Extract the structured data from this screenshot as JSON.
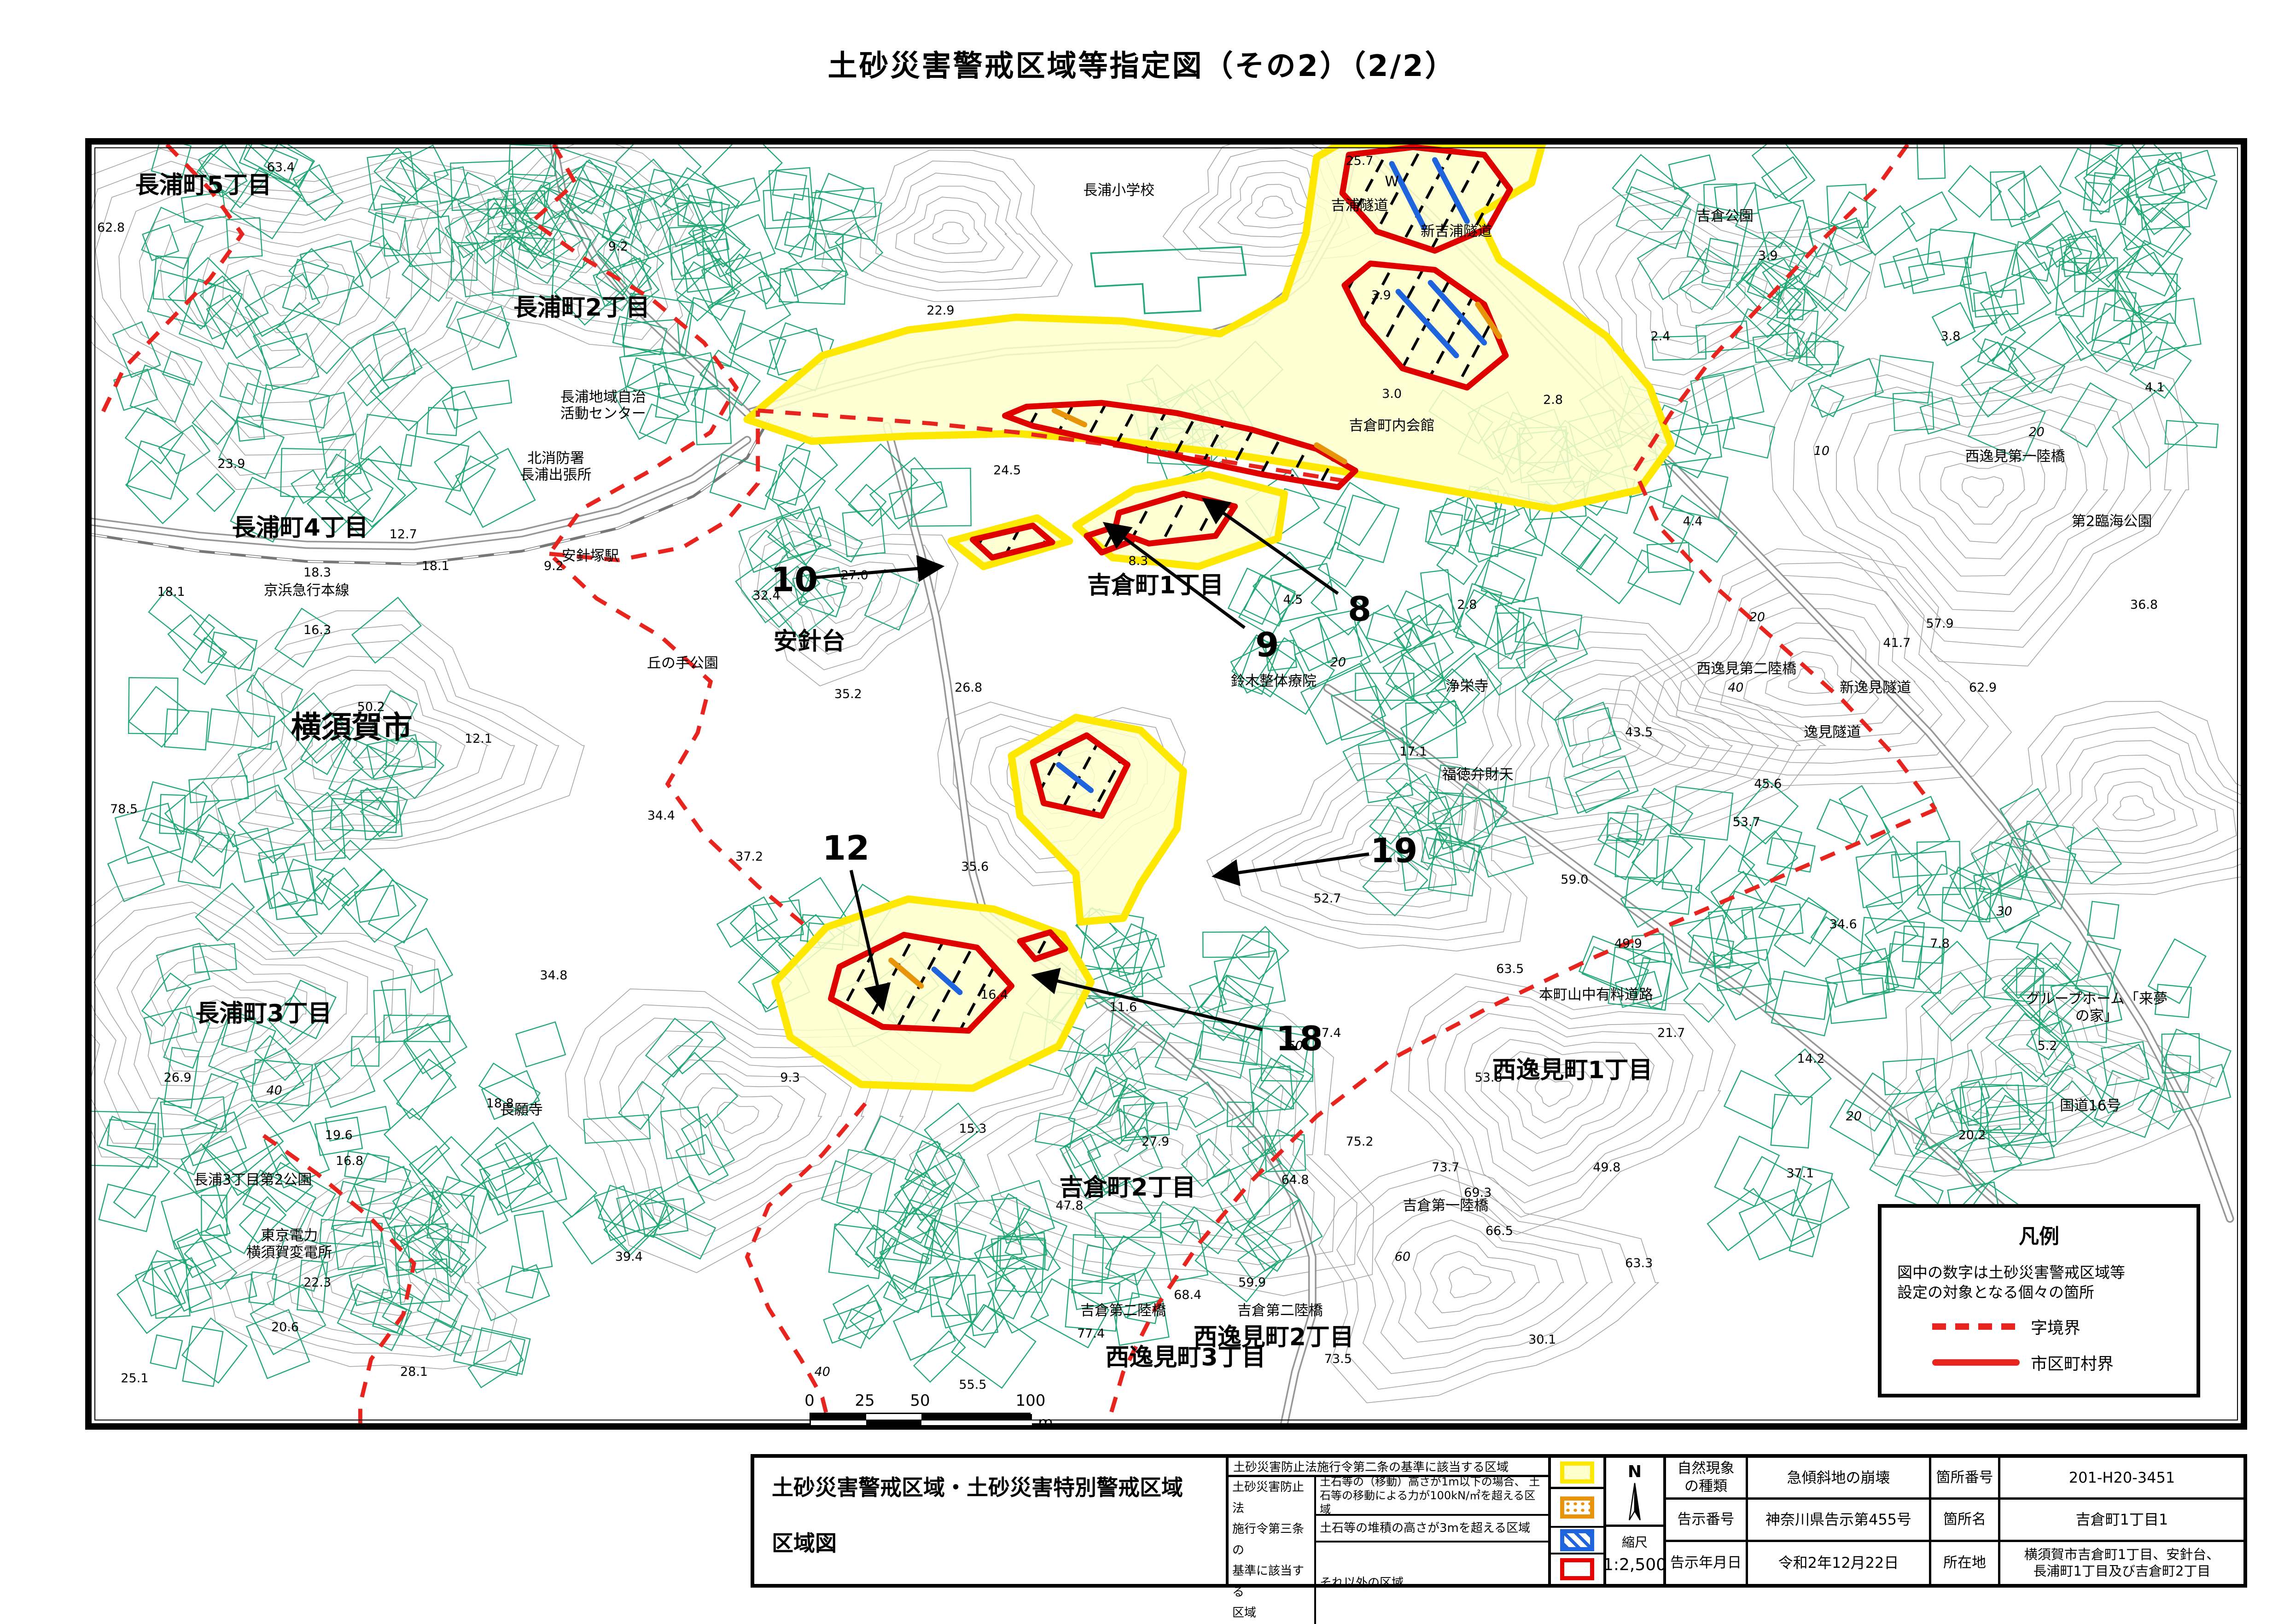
{
  "page": {
    "title": "土砂災害警戒区域等指定図（その2）（2/2）"
  },
  "scalebar": {
    "ticks": [
      "0",
      "25",
      "50",
      "100"
    ],
    "unit": "m"
  },
  "legend_box": {
    "title": "凡例",
    "note": "図中の数字は土砂災害警戒区域等\n設定の対象となる個々の箇所",
    "items": [
      {
        "style": "dashed",
        "label": "字境界"
      },
      {
        "style": "solid",
        "label": "市区町村界"
      }
    ]
  },
  "footer": {
    "doc_title_line1": "土砂災害警戒区域・土砂災害特別警戒区域",
    "doc_title_line2": "区域図",
    "legend": {
      "row1": "土砂災害防止法施行令第二条の基準に該当する区域",
      "group_label": "土砂災害防止法\n施行令第三条の\n基準に該当する\n区域",
      "row2": "土石等の（移動）高さが1m以下の場合、\n土石等の移動による力が100kN/㎡を超える区域",
      "row3": "土石等の堆積の高さが3mを超える区域",
      "row4": "それ以外の区域"
    },
    "north_label": "N",
    "scale_label": "縮尺",
    "scale_value": "1:2,500",
    "info": {
      "phenomenon_label": "自然現象\nの種類",
      "phenomenon": "急傾斜地の崩壊",
      "site_no_label": "箇所番号",
      "site_no": "201-H20-3451",
      "notice_no_label": "告示番号",
      "notice_no": "神奈川県告示第455号",
      "site_name_label": "箇所名",
      "site_name": "吉倉町1丁目1",
      "notice_date_label": "告示年月日",
      "notice_date": "令和2年12月22日",
      "location_label": "所在地",
      "location": "横須賀市吉倉町1丁目、安針台、\n長浦町1丁目及び吉倉町2丁目"
    }
  },
  "map": {
    "colors": {
      "hazard_yellow_fill": "#FFFFCC",
      "hazard_yellow_border": "#FFE800",
      "special_red": "#DF0000",
      "debris_orange": "#E8940A",
      "deposit_blue": "#1E64DC",
      "boundary_red": "#E8241F",
      "contour_gray": "#A3A3A3",
      "building_green": "#21A876",
      "road_gray": "#8C8C8C"
    },
    "pointers": [
      {
        "n": "8",
        "x": 59.0,
        "y": 36.3,
        "tx": 51.8,
        "ty": 27.8
      },
      {
        "n": "9",
        "x": 54.7,
        "y": 39.1,
        "tx": 47.2,
        "ty": 29.7
      },
      {
        "n": "10",
        "x": 32.7,
        "y": 34.0,
        "tx": 39.5,
        "ty": 33.0
      },
      {
        "n": "12",
        "x": 35.1,
        "y": 55.0,
        "tx": 36.8,
        "ty": 67.5
      },
      {
        "n": "18",
        "x": 56.2,
        "y": 69.9,
        "tx": 43.9,
        "ty": 65.0
      },
      {
        "n": "19",
        "x": 60.6,
        "y": 55.2,
        "tx": 52.3,
        "ty": 57.2
      }
    ],
    "labels": [
      {
        "t": "長浦町5丁目",
        "x": 5.2,
        "y": 3.2,
        "c": "lg"
      },
      {
        "t": "長浦町2丁目",
        "x": 22.8,
        "y": 12.8,
        "c": "lg"
      },
      {
        "t": "長浦町4丁目",
        "x": 9.7,
        "y": 30.0,
        "c": "lg"
      },
      {
        "t": "長浦町3丁目",
        "x": 8.0,
        "y": 68.0,
        "c": "lg"
      },
      {
        "t": "横須賀市",
        "x": 12.1,
        "y": 45.6,
        "c": "xl"
      },
      {
        "t": "安針台",
        "x": 33.4,
        "y": 38.9,
        "c": "lg"
      },
      {
        "t": "吉倉町1丁目",
        "x": 49.5,
        "y": 34.5,
        "c": "lg"
      },
      {
        "t": "吉倉町2丁目",
        "x": 48.2,
        "y": 81.6,
        "c": "lg"
      },
      {
        "t": "西逸見町1丁目",
        "x": 68.9,
        "y": 72.4,
        "c": "lg"
      },
      {
        "t": "西逸見町2丁目",
        "x": 55.0,
        "y": 93.3,
        "c": "lg"
      },
      {
        "t": "西逸見町3丁目",
        "x": 50.9,
        "y": 94.9,
        "c": "lg"
      },
      {
        "t": "長浦小学校",
        "x": 47.8,
        "y": 3.6,
        "c": "sm"
      },
      {
        "t": "W",
        "x": 60.5,
        "y": 2.9,
        "c": "sm"
      },
      {
        "t": "吉浦隧道",
        "x": 59.0,
        "y": 4.8,
        "c": "sm"
      },
      {
        "t": "新吉浦隧道",
        "x": 63.5,
        "y": 6.8,
        "c": "sm"
      },
      {
        "t": "吉倉町内会館",
        "x": 60.5,
        "y": 22.0,
        "c": "sm"
      },
      {
        "t": "吉倉公園",
        "x": 76.0,
        "y": 5.6,
        "c": "sm"
      },
      {
        "t": "西逸見第一陸橋",
        "x": 89.5,
        "y": 24.4,
        "c": "sm"
      },
      {
        "t": "第2臨海公園",
        "x": 94.0,
        "y": 29.5,
        "c": "sm"
      },
      {
        "t": "長浦地域自治\n活動センター",
        "x": 23.8,
        "y": 20.4,
        "c": "sm"
      },
      {
        "t": "北消防署\n長浦出張所",
        "x": 21.6,
        "y": 25.2,
        "c": "sm"
      },
      {
        "t": "安針塚駅",
        "x": 23.2,
        "y": 32.2,
        "c": "sm"
      },
      {
        "t": "丘の手公園",
        "x": 27.5,
        "y": 40.6,
        "c": "sm"
      },
      {
        "t": "京浜急行本線",
        "x": 10.0,
        "y": 34.9,
        "c": "sm"
      },
      {
        "t": "鈴木整体療院",
        "x": 55.0,
        "y": 42.0,
        "c": "sm"
      },
      {
        "t": "浄栄寺",
        "x": 64.0,
        "y": 42.4,
        "c": "sm"
      },
      {
        "t": "西逸見第二陸橋",
        "x": 77.0,
        "y": 41.0,
        "c": "sm"
      },
      {
        "t": "新逸見隧道",
        "x": 83.0,
        "y": 42.5,
        "c": "sm"
      },
      {
        "t": "逸見隧道",
        "x": 81.0,
        "y": 46.0,
        "c": "sm"
      },
      {
        "t": "福徳弁財天",
        "x": 64.5,
        "y": 49.3,
        "c": "sm"
      },
      {
        "t": "長願寺",
        "x": 20.0,
        "y": 75.5,
        "c": "sm"
      },
      {
        "t": "長浦3丁目第2公園",
        "x": 7.5,
        "y": 81.0,
        "c": "sm"
      },
      {
        "t": "東京電力\n横須賀変電所",
        "x": 9.2,
        "y": 86.0,
        "c": "sm"
      },
      {
        "t": "本町山中有料道路",
        "x": 70.0,
        "y": 66.5,
        "c": "sm"
      },
      {
        "t": "グループホーム「来夢の家」",
        "x": 93.3,
        "y": 67.5,
        "c": "sm"
      },
      {
        "t": "国道16号",
        "x": 93.0,
        "y": 75.2,
        "c": "sm"
      },
      {
        "t": "吉倉第一陸橋",
        "x": 63.0,
        "y": 83.0,
        "c": "sm"
      },
      {
        "t": "吉倉第二陸橋",
        "x": 48.0,
        "y": 91.2,
        "c": "sm"
      },
      {
        "t": "吉倉第二陸橋",
        "x": 55.3,
        "y": 91.2,
        "c": "sm"
      },
      {
        "t": "63.4",
        "x": 8.8,
        "y": 1.8,
        "c": "el"
      },
      {
        "t": "62.8",
        "x": 0.9,
        "y": 6.5,
        "c": "el"
      },
      {
        "t": "9.2",
        "x": 24.5,
        "y": 8.0,
        "c": "el"
      },
      {
        "t": "23.9",
        "x": 6.5,
        "y": 25.0,
        "c": "el"
      },
      {
        "t": "12.7",
        "x": 14.5,
        "y": 30.5,
        "c": "el"
      },
      {
        "t": "16.3",
        "x": 10.5,
        "y": 38.0,
        "c": "el"
      },
      {
        "t": "9.2",
        "x": 21.5,
        "y": 33.0,
        "c": "el"
      },
      {
        "t": "22.9",
        "x": 39.5,
        "y": 13.0,
        "c": "el"
      },
      {
        "t": "25.7",
        "x": 59.0,
        "y": 1.3,
        "c": "el"
      },
      {
        "t": "24.5",
        "x": 42.6,
        "y": 25.5,
        "c": "el"
      },
      {
        "t": "27.0",
        "x": 35.5,
        "y": 33.7,
        "c": "el"
      },
      {
        "t": "32.4",
        "x": 31.4,
        "y": 35.3,
        "c": "el"
      },
      {
        "t": "35.2",
        "x": 35.2,
        "y": 43.0,
        "c": "el"
      },
      {
        "t": "34.4",
        "x": 26.5,
        "y": 52.5,
        "c": "el"
      },
      {
        "t": "37.2",
        "x": 30.6,
        "y": 55.7,
        "c": "el"
      },
      {
        "t": "12.1",
        "x": 18.0,
        "y": 46.5,
        "c": "el"
      },
      {
        "t": "18.1",
        "x": 3.7,
        "y": 35.0,
        "c": "el"
      },
      {
        "t": "18.3",
        "x": 10.5,
        "y": 33.5,
        "c": "el"
      },
      {
        "t": "18.1",
        "x": 16.0,
        "y": 33.0,
        "c": "el"
      },
      {
        "t": "50.2",
        "x": 13.0,
        "y": 44.0,
        "c": "el"
      },
      {
        "t": "78.5",
        "x": 1.5,
        "y": 52.0,
        "c": "el"
      },
      {
        "t": "26.9",
        "x": 4.0,
        "y": 73.0,
        "c": "el"
      },
      {
        "t": "19.6",
        "x": 11.5,
        "y": 77.5,
        "c": "el"
      },
      {
        "t": "18.8",
        "x": 19.0,
        "y": 75.0,
        "c": "el"
      },
      {
        "t": "34.8",
        "x": 21.5,
        "y": 65.0,
        "c": "el"
      },
      {
        "t": "22.3",
        "x": 10.5,
        "y": 89.0,
        "c": "el"
      },
      {
        "t": "39.4",
        "x": 25.0,
        "y": 87.0,
        "c": "el"
      },
      {
        "t": "28.1",
        "x": 15.0,
        "y": 96.0,
        "c": "el"
      },
      {
        "t": "25.1",
        "x": 2.0,
        "y": 96.5,
        "c": "el"
      },
      {
        "t": "20.6",
        "x": 9.0,
        "y": 92.5,
        "c": "el"
      },
      {
        "t": "16.8",
        "x": 12.0,
        "y": 79.5,
        "c": "el"
      },
      {
        "t": "8.3",
        "x": 48.7,
        "y": 32.6,
        "c": "el"
      },
      {
        "t": "4.5",
        "x": 55.9,
        "y": 35.6,
        "c": "el"
      },
      {
        "t": "26.8",
        "x": 40.8,
        "y": 42.5,
        "c": "el"
      },
      {
        "t": "35.6",
        "x": 41.1,
        "y": 56.5,
        "c": "el"
      },
      {
        "t": "3.9",
        "x": 60.0,
        "y": 11.8,
        "c": "el"
      },
      {
        "t": "3.0",
        "x": 60.5,
        "y": 19.5,
        "c": "el"
      },
      {
        "t": "2.8",
        "x": 68.0,
        "y": 20.0,
        "c": "el"
      },
      {
        "t": "2.4",
        "x": 73.0,
        "y": 15.0,
        "c": "el"
      },
      {
        "t": "3.9",
        "x": 78.0,
        "y": 8.7,
        "c": "el"
      },
      {
        "t": "3.8",
        "x": 86.5,
        "y": 15.0,
        "c": "el"
      },
      {
        "t": "4.1",
        "x": 96.0,
        "y": 19.0,
        "c": "el"
      },
      {
        "t": "4.4",
        "x": 74.5,
        "y": 29.5,
        "c": "el"
      },
      {
        "t": "36.8",
        "x": 95.5,
        "y": 36.0,
        "c": "el"
      },
      {
        "t": "62.9",
        "x": 88.0,
        "y": 42.5,
        "c": "el"
      },
      {
        "t": "57.9",
        "x": 86.0,
        "y": 37.5,
        "c": "el"
      },
      {
        "t": "41.7",
        "x": 84.0,
        "y": 39.0,
        "c": "el"
      },
      {
        "t": "45.6",
        "x": 78.0,
        "y": 50.0,
        "c": "el"
      },
      {
        "t": "43.5",
        "x": 72.0,
        "y": 46.0,
        "c": "el"
      },
      {
        "t": "53.7",
        "x": 77.0,
        "y": 53.0,
        "c": "el"
      },
      {
        "t": "59.0",
        "x": 69.0,
        "y": 57.5,
        "c": "el"
      },
      {
        "t": "17.1",
        "x": 61.5,
        "y": 47.5,
        "c": "el"
      },
      {
        "t": "2.8",
        "x": 64.0,
        "y": 36.0,
        "c": "el"
      },
      {
        "t": "52.7",
        "x": 57.5,
        "y": 59.0,
        "c": "el"
      },
      {
        "t": "16.4",
        "x": 42.0,
        "y": 66.5,
        "c": "el"
      },
      {
        "t": "11.6",
        "x": 48.0,
        "y": 67.5,
        "c": "el"
      },
      {
        "t": "15.3",
        "x": 41.0,
        "y": 77.0,
        "c": "el"
      },
      {
        "t": "27.9",
        "x": 49.5,
        "y": 78.0,
        "c": "el"
      },
      {
        "t": "64.8",
        "x": 56.0,
        "y": 81.0,
        "c": "el"
      },
      {
        "t": "9.3",
        "x": 32.5,
        "y": 73.0,
        "c": "el"
      },
      {
        "t": "47.8",
        "x": 45.5,
        "y": 83.0,
        "c": "el"
      },
      {
        "t": "69.3",
        "x": 64.5,
        "y": 82.0,
        "c": "el"
      },
      {
        "t": "73.7",
        "x": 63.0,
        "y": 80.0,
        "c": "el"
      },
      {
        "t": "66.5",
        "x": 65.5,
        "y": 85.0,
        "c": "el"
      },
      {
        "t": "49.8",
        "x": 70.5,
        "y": 80.0,
        "c": "el"
      },
      {
        "t": "63.3",
        "x": 72.0,
        "y": 87.5,
        "c": "el"
      },
      {
        "t": "55.5",
        "x": 41.0,
        "y": 97.0,
        "c": "el"
      },
      {
        "t": "59.9",
        "x": 54.0,
        "y": 89.0,
        "c": "el"
      },
      {
        "t": "68.4",
        "x": 51.0,
        "y": 90.0,
        "c": "el"
      },
      {
        "t": "77.4",
        "x": 46.5,
        "y": 93.0,
        "c": "el"
      },
      {
        "t": "73.5",
        "x": 58.0,
        "y": 95.0,
        "c": "el"
      },
      {
        "t": "30.1",
        "x": 67.5,
        "y": 93.5,
        "c": "el"
      },
      {
        "t": "34.6",
        "x": 81.5,
        "y": 61.0,
        "c": "el"
      },
      {
        "t": "7.8",
        "x": 86.0,
        "y": 62.5,
        "c": "el"
      },
      {
        "t": "49.9",
        "x": 71.5,
        "y": 62.5,
        "c": "el"
      },
      {
        "t": "63.5",
        "x": 66.0,
        "y": 64.5,
        "c": "el"
      },
      {
        "t": "53.8",
        "x": 65.0,
        "y": 73.0,
        "c": "el"
      },
      {
        "t": "21.7",
        "x": 73.5,
        "y": 69.5,
        "c": "el"
      },
      {
        "t": "14.2",
        "x": 80.0,
        "y": 71.5,
        "c": "el"
      },
      {
        "t": "5.2",
        "x": 91.0,
        "y": 70.5,
        "c": "el"
      },
      {
        "t": "20.2",
        "x": 87.5,
        "y": 77.5,
        "c": "el"
      },
      {
        "t": "37.1",
        "x": 79.5,
        "y": 80.5,
        "c": "el"
      },
      {
        "t": "75.2",
        "x": 59.0,
        "y": 78.0,
        "c": "el"
      },
      {
        "t": "57.4",
        "x": 57.5,
        "y": 69.5,
        "c": "el"
      },
      {
        "t": "40",
        "x": 8.5,
        "y": 74.0,
        "c": "ct"
      },
      {
        "t": "20",
        "x": 58.0,
        "y": 40.5,
        "c": "ct"
      },
      {
        "t": "10",
        "x": 80.5,
        "y": 24.0,
        "c": "ct"
      },
      {
        "t": "20",
        "x": 90.5,
        "y": 22.5,
        "c": "ct"
      },
      {
        "t": "60",
        "x": 61.0,
        "y": 87.0,
        "c": "ct"
      },
      {
        "t": "50",
        "x": 56.0,
        "y": 70.5,
        "c": "ct"
      },
      {
        "t": "40",
        "x": 76.5,
        "y": 42.5,
        "c": "ct"
      },
      {
        "t": "20",
        "x": 77.5,
        "y": 37.0,
        "c": "ct"
      },
      {
        "t": "20",
        "x": 82.0,
        "y": 76.0,
        "c": "ct"
      },
      {
        "t": "30",
        "x": 89.0,
        "y": 60.0,
        "c": "ct"
      },
      {
        "t": "50",
        "x": 56.0,
        "y": 70.5,
        "c": "ct"
      },
      {
        "t": "40",
        "x": 34.0,
        "y": 96.0,
        "c": "ct"
      }
    ]
  }
}
